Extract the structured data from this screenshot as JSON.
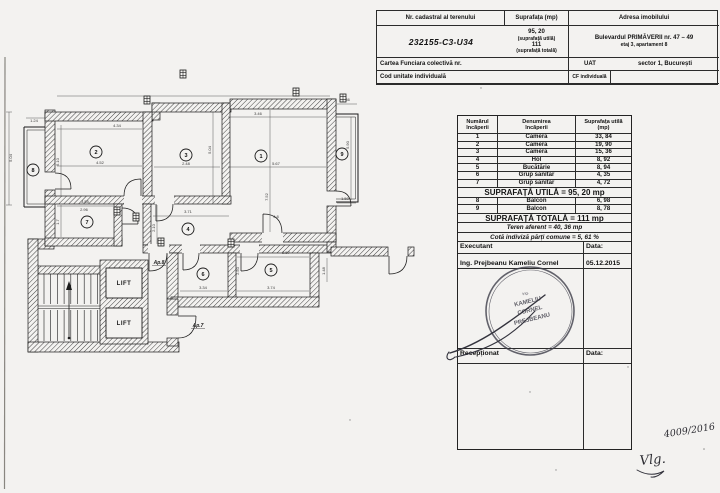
{
  "colors": {
    "ink": "#1b1b1b",
    "paper": "#f3f2f0",
    "stamp": "#3f3f4a"
  },
  "header_table": {
    "nr_cadastral_label": "Nr. cadastral al terenului",
    "nr_cadastral_value": "232155-C3-U34",
    "suprafata_label": "Suprafața (mp)",
    "suprafata_utila_value": "95, 20",
    "suprafata_utila_note": "(suprafață utilă)",
    "suprafata_totala_value": "111",
    "suprafata_totala_note": "(suprafață totală)",
    "adresa_label": "Adresa imobilului",
    "adresa_line1": "Bulevardul PRIMĂVERII nr. 47 – 49",
    "adresa_line2": "etaj 3, apartament 8",
    "carte_funciara_label": "Cartea Funciara colectivă nr.",
    "uat_label": "UAT",
    "uat_value": "sector 1, București",
    "cod_unitate_label": "Cod unitate individuală",
    "cf_label": "CF individuală"
  },
  "rooms_table": {
    "headers": [
      {
        "l1": "Numărul",
        "l2": "încăperii"
      },
      {
        "l1": "Denumirea",
        "l2": "încăperii"
      },
      {
        "l1": "Suprafața utilă",
        "l2": "(mp)"
      }
    ],
    "rows": [
      {
        "nr": "1",
        "name": "Cameră",
        "area": "33, 84"
      },
      {
        "nr": "2",
        "name": "Cameră",
        "area": "19, 90"
      },
      {
        "nr": "3",
        "name": "Cameră",
        "area": "15, 36"
      },
      {
        "nr": "4",
        "name": "Hol",
        "area": "8, 92"
      },
      {
        "nr": "5",
        "name": "Bucătărie",
        "area": "8, 94"
      },
      {
        "nr": "6",
        "name": "Grup sanitar",
        "area": "4, 35"
      },
      {
        "nr": "7",
        "name": "Grup sanitar",
        "area": "4, 72"
      }
    ],
    "suprafata_utila_total": "SUPRAFAȚĂ UTILĂ = 95, 20 mp",
    "balcony_rows": [
      {
        "nr": "8",
        "name": "Balcon",
        "area": "6, 98"
      },
      {
        "nr": "9",
        "name": "Balcon",
        "area": "8, 78"
      }
    ],
    "suprafata_totala": "SUPRAFAȚĂ TOTALĂ = 111 mp",
    "teren_aferent": "Teren aferent = 40, 36 mp",
    "cota_indiviza": "Cotă indiviză părți comune = 5, 61 %",
    "executant_label": "Executant",
    "executant_data_label": "Data:",
    "executant_name": "Ing. Prejbeanu Kameliu Cornel",
    "executant_date": "05.12.2015",
    "receptionat_label": "Recepționat",
    "receptionat_data_label": "Data:"
  },
  "plan": {
    "lift_label": "LIFT",
    "room_numbers": [
      {
        "n": "1",
        "x": 261,
        "y": 156
      },
      {
        "n": "2",
        "x": 96,
        "y": 152
      },
      {
        "n": "3",
        "x": 186,
        "y": 155
      },
      {
        "n": "4",
        "x": 188,
        "y": 229
      },
      {
        "n": "5",
        "x": 271,
        "y": 270
      },
      {
        "n": "6",
        "x": 203,
        "y": 274
      },
      {
        "n": "7",
        "x": 87,
        "y": 222
      },
      {
        "n": "8",
        "x": 33,
        "y": 170
      },
      {
        "n": "9",
        "x": 342,
        "y": 154
      }
    ],
    "door_labels": [
      {
        "t": "Ap.8",
        "x": 159,
        "y": 264
      },
      {
        "t": "Ap.7",
        "x": 198,
        "y": 327
      }
    ],
    "dimensions": [
      {
        "x": 117,
        "y": 127,
        "t": "4.34"
      },
      {
        "x": 100,
        "y": 164,
        "t": "4.52"
      },
      {
        "x": 59,
        "y": 162,
        "t": "5.10",
        "r": -90
      },
      {
        "x": 186,
        "y": 165,
        "t": "2.48"
      },
      {
        "x": 211,
        "y": 150,
        "t": "5.04",
        "r": -90
      },
      {
        "x": 258,
        "y": 115,
        "t": "3.46"
      },
      {
        "x": 276,
        "y": 165,
        "t": "5.67"
      },
      {
        "x": 268,
        "y": 197,
        "t": "7.52",
        "r": -90
      },
      {
        "x": 276,
        "y": 218,
        "t": "4.8"
      },
      {
        "x": 346,
        "y": 101,
        "t": "2.86"
      },
      {
        "x": 345,
        "y": 200,
        "t": "1.50"
      },
      {
        "x": 349,
        "y": 145,
        "t": "5.90",
        "r": -90
      },
      {
        "x": 85,
        "y": 203,
        "t": "3.55"
      },
      {
        "x": 84,
        "y": 211,
        "t": "2.96"
      },
      {
        "x": 59,
        "y": 222,
        "t": "1.7",
        "r": -90
      },
      {
        "x": 188,
        "y": 213,
        "t": "3.71"
      },
      {
        "x": 155,
        "y": 228,
        "t": "2.10",
        "r": -90
      },
      {
        "x": 203,
        "y": 289,
        "t": "3.34"
      },
      {
        "x": 271,
        "y": 289,
        "t": "3.74"
      },
      {
        "x": 286,
        "y": 254,
        "t": "2.57"
      },
      {
        "x": 239,
        "y": 271,
        "t": "2.50",
        "r": -90
      },
      {
        "x": 325,
        "y": 271,
        "t": "1.48",
        "r": -90
      },
      {
        "x": 34,
        "y": 122,
        "t": "1.24"
      },
      {
        "x": 12,
        "y": 158,
        "t": "5.04",
        "r": -90
      }
    ],
    "vents": [
      [
        180,
        70
      ],
      [
        144,
        96
      ],
      [
        293,
        88
      ],
      [
        340,
        94
      ],
      [
        114,
        207
      ],
      [
        133,
        213
      ],
      [
        158,
        238
      ],
      [
        228,
        239
      ]
    ]
  },
  "stamp": {
    "line1": "ing.",
    "line2": "KAMELIU",
    "line3": "CORNEL",
    "line4": "PREJBEANU"
  },
  "annotations": {
    "number": "4009/2016",
    "signature": "Vlg."
  }
}
